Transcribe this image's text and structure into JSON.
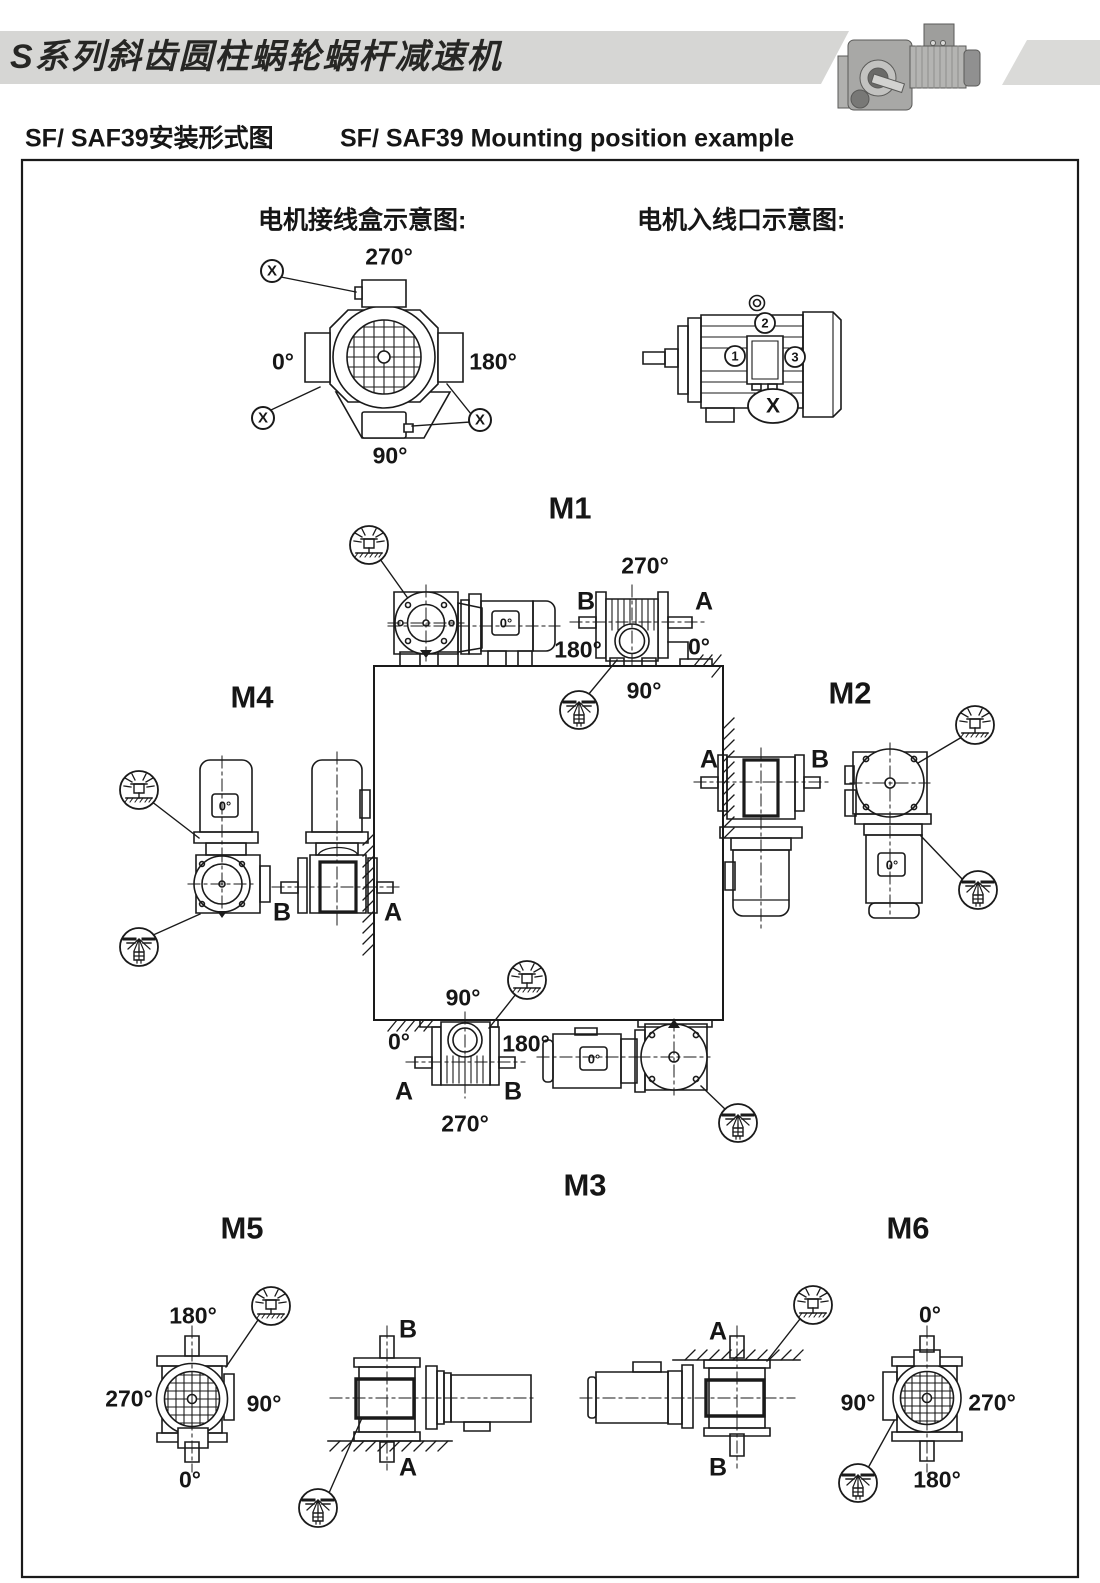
{
  "page": {
    "header_title": "S系列斜齿圆柱蜗轮蜗杆减速机",
    "subtitle_zh": "SF/ SAF39安装形式图",
    "subtitle_en": "SF/ SAF39 Mounting position example"
  },
  "legend": {
    "junction_box": {
      "title": "电机接线盒示意图:",
      "angle_top": "270°",
      "angle_left": "0°",
      "angle_right": "180°",
      "angle_bottom": "90°",
      "marker": "X"
    },
    "cable_entry": {
      "title": "电机入线口示意图:",
      "pos_left": "1",
      "pos_top": "2",
      "pos_right": "3",
      "marker": "X"
    }
  },
  "positions": {
    "m1": {
      "label": "M1",
      "motor_angle": "0°",
      "angle_top": "270°",
      "angle_left": "180°",
      "angle_right": "0°",
      "angle_bottom": "90°",
      "shaft_left": "B",
      "shaft_right": "A"
    },
    "m2": {
      "label": "M2",
      "motor_angle": "0°",
      "shaft_left": "A",
      "shaft_right": "B"
    },
    "m3": {
      "label": "M3",
      "motor_angle": "0°",
      "angle_top": "90°",
      "angle_left": "0°",
      "angle_right": "180°",
      "angle_bottom": "270°",
      "shaft_left": "A",
      "shaft_right": "B"
    },
    "m4": {
      "label": "M4",
      "motor_angle": "0°",
      "shaft_left": "B",
      "shaft_right": "A"
    },
    "m5": {
      "label": "M5",
      "angle_top": "180°",
      "angle_left": "270°",
      "angle_right": "90°",
      "angle_bottom": "0°",
      "shaft_top": "B",
      "shaft_bottom": "A"
    },
    "m6": {
      "label": "M6",
      "angle_top": "0°",
      "angle_left": "90°",
      "angle_right": "270°",
      "angle_bottom": "180°",
      "shaft_top": "A",
      "shaft_bottom": "B"
    }
  },
  "symbols": {
    "vent": "breather-vent-plug",
    "drain": "oil-drain-plug",
    "junction_marker": "circled-x"
  },
  "colors": {
    "band": "#d6d6d4",
    "accent_band": "#dadad8",
    "line": "#1a1a1a"
  }
}
